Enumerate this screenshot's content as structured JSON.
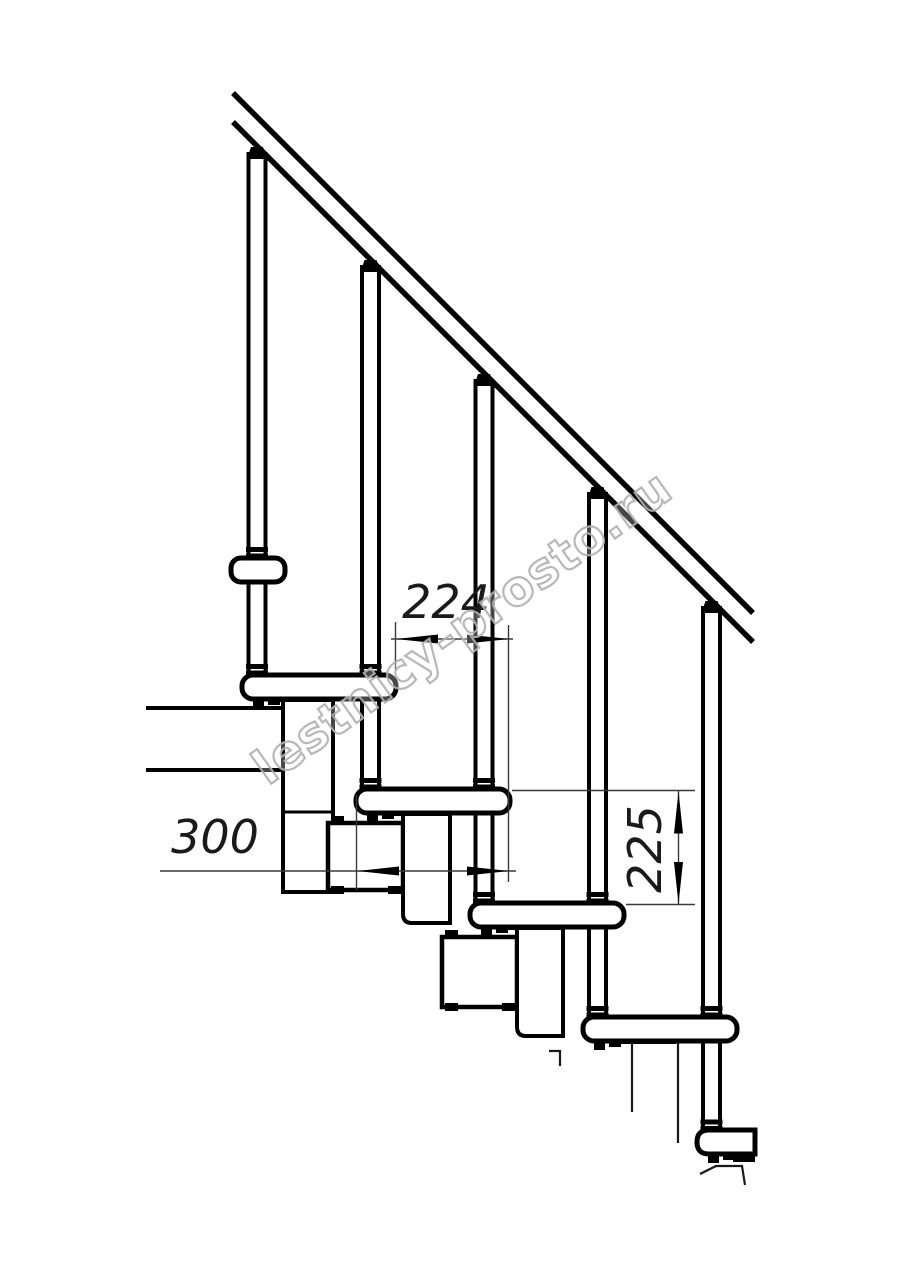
{
  "drawing": {
    "type": "staircase-side-elevation",
    "dimensions": {
      "run": {
        "label": "224",
        "orientation": "horizontal"
      },
      "tread_depth": {
        "label": "300",
        "orientation": "horizontal"
      },
      "rise": {
        "label": "225",
        "orientation": "vertical"
      }
    },
    "watermark": {
      "text": "lestnicy-prosto.ru",
      "color": "#b0b0b0"
    },
    "colors": {
      "line": "#000000",
      "background": "#ffffff",
      "dim_line": "#3a3a3a",
      "dim_text": "#1a1a1a"
    },
    "components": {
      "treads": 6,
      "balusters": 5,
      "handrail_lines": 2,
      "module_boxes": 5
    }
  }
}
